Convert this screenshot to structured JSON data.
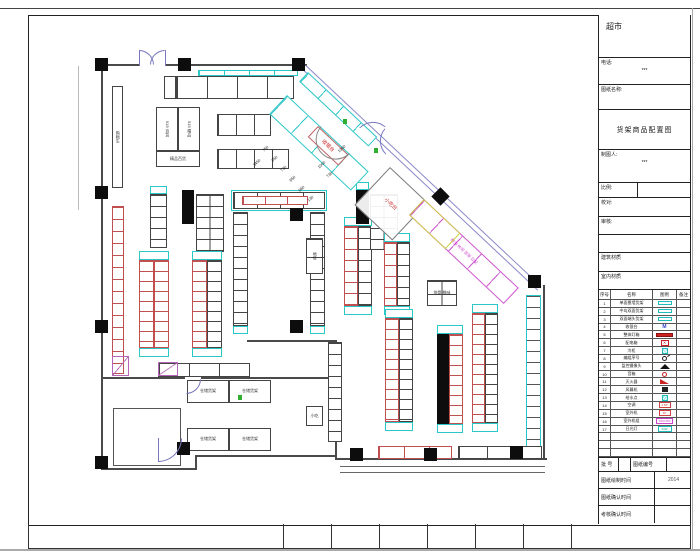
{
  "sheet": {
    "title": "超市",
    "titleblock": {
      "phone_label": "电话:",
      "phone_value": "***",
      "name_label": "图纸名称:",
      "drawing_name": "货架商品配置图",
      "drafter_label": "制图人:",
      "drafter_value": "***",
      "scale_label": "比例:",
      "check_label": "校对:",
      "review_label": "审核:",
      "building_label": "建筑材质",
      "interior_label": "室内材质",
      "batch_label": "批 号",
      "sheet_no_label": "图纸编号",
      "draw_time_label": "图纸绘制时间",
      "draw_time_value": "2014",
      "confirm_time_label": "图纸确认时间",
      "confirm_time_value": "",
      "review_time_label": "考核确认时间",
      "review_time_value": ""
    }
  },
  "legend": {
    "headers": [
      "序号",
      "名称",
      "图例",
      "备注"
    ],
    "rows": [
      {
        "no": "1",
        "name": "单面靠墙货架",
        "sym": "cyanrect",
        "glyph": ""
      },
      {
        "no": "2",
        "name": "中岛双面货架",
        "sym": "cyanrect",
        "glyph": ""
      },
      {
        "no": "3",
        "name": "双面端头货架",
        "sym": "cyanrect",
        "glyph": ""
      },
      {
        "no": "4",
        "name": "收银台",
        "sym": "mtext",
        "glyph": "M"
      },
      {
        "no": "5",
        "name": "整体灯箱",
        "sym": "redbar",
        "glyph": ""
      },
      {
        "no": "6",
        "name": "配电箱",
        "sym": "redx",
        "glyph": "✕"
      },
      {
        "no": "7",
        "name": "冷柜",
        "sym": "cyansq",
        "glyph": ""
      },
      {
        "no": "8",
        "name": "编组序号",
        "sym": "circle",
        "glyph": ""
      },
      {
        "no": "9",
        "name": "监控摄像头",
        "sym": "trap",
        "glyph": ""
      },
      {
        "no": "10",
        "name": "音箱",
        "sym": "ring",
        "glyph": ""
      },
      {
        "no": "11",
        "name": "灭火器",
        "sym": "wedge",
        "glyph": ""
      },
      {
        "no": "12",
        "name": "风幕机",
        "sym": "darksq",
        "glyph": ""
      },
      {
        "no": "13",
        "name": "给水点",
        "sym": "hatch",
        "glyph": ""
      },
      {
        "no": "14",
        "name": "空调",
        "sym": "redbox",
        "glyph": "1.5P"
      },
      {
        "no": "15",
        "name": "室外机",
        "sym": "redbox",
        "glyph": "2P"
      },
      {
        "no": "16",
        "name": "室外机组",
        "sym": "magbox",
        "glyph": "700×450"
      },
      {
        "no": "17",
        "name": "日光灯",
        "sym": "cyanbox",
        "glyph": "40W"
      },
      {
        "no": "",
        "name": "",
        "sym": "",
        "glyph": ""
      },
      {
        "no": "",
        "name": "",
        "sym": "",
        "glyph": ""
      },
      {
        "no": "",
        "name": "",
        "sym": "",
        "glyph": ""
      }
    ]
  },
  "plan": {
    "walls": [
      [
        101,
        64,
        38,
        2,
        "#4a4a4a"
      ],
      [
        166,
        64,
        141,
        2,
        "#4a4a4a"
      ],
      [
        101,
        64,
        2,
        406,
        "#4a4a4a"
      ],
      [
        101,
        468,
        96,
        2,
        "#4a4a4a"
      ],
      [
        195,
        456,
        2,
        14,
        "#4a4a4a"
      ],
      [
        195,
        455,
        142,
        2,
        "#4a4a4a"
      ],
      [
        335,
        341,
        2,
        119,
        "#4a4a4a"
      ],
      [
        247,
        340,
        90,
        2,
        "#4a4a4a"
      ],
      [
        335,
        458,
        212,
        2,
        "#4a4a4a"
      ],
      [
        340,
        466,
        205,
        1,
        "#666"
      ],
      [
        340,
        472,
        205,
        1,
        "#666"
      ],
      [
        543,
        285,
        2,
        175,
        "#4a4a4a"
      ],
      [
        101,
        377,
        84,
        2,
        "#4a4a4a"
      ],
      [
        201,
        377,
        136,
        2,
        "#4a4a4a"
      ],
      [
        78,
        66,
        1,
        144,
        "#bbb"
      ],
      [
        139,
        50,
        1,
        16,
        "#7878c0"
      ],
      [
        165,
        50,
        1,
        16,
        "#7878c0"
      ],
      [
        158,
        438,
        1,
        24,
        "#7878c0"
      ]
    ],
    "diag_wall": {
      "x": 306,
      "y": 65,
      "len": 323,
      "a": 43.2,
      "c": "#8888c8"
    },
    "columns": [
      [
        95,
        58
      ],
      [
        178,
        58
      ],
      [
        292,
        58
      ],
      [
        95,
        186
      ],
      [
        95,
        320
      ],
      [
        95,
        456
      ],
      [
        177,
        442
      ],
      [
        290,
        208
      ],
      [
        290,
        320
      ],
      [
        350,
        448
      ],
      [
        424,
        448
      ],
      [
        510,
        446
      ],
      [
        528,
        275
      ]
    ],
    "diamonds": [
      [
        434,
        190
      ]
    ],
    "solids": [
      [
        182,
        190,
        12,
        34
      ],
      [
        356,
        190,
        13,
        34
      ],
      [
        437,
        334,
        12,
        90
      ]
    ],
    "runs": [
      {
        "x": 164,
        "y": 76,
        "w": 12,
        "h": 23,
        "b": "blk"
      },
      {
        "x": 176,
        "y": 76,
        "w": 118,
        "h": 23,
        "o": "h",
        "b": "blk",
        "p": 30
      },
      {
        "x": 198,
        "y": 70,
        "w": 100,
        "h": 6,
        "o": "h",
        "b": "cyan",
        "p": 25
      },
      {
        "x": 156,
        "y": 107,
        "w": 22,
        "h": 44,
        "b": "blk",
        "label": "915 百货",
        "lr": 1
      },
      {
        "x": 178,
        "y": 107,
        "w": 22,
        "h": 44,
        "b": "blk",
        "label": "915 精品",
        "lr": 1
      },
      {
        "x": 156,
        "y": 151,
        "w": 44,
        "h": 16,
        "b": "blk",
        "label": "精品百货"
      },
      {
        "x": 217,
        "y": 114,
        "w": 54,
        "h": 22,
        "o": "h",
        "b": "blk",
        "p": 18
      },
      {
        "x": 217,
        "y": 149,
        "w": 72,
        "h": 20,
        "o": "h",
        "b": "blk",
        "p": 18
      },
      {
        "x": 112,
        "y": 86,
        "w": 11,
        "h": 102,
        "b": "blk",
        "label": "购物车",
        "lr": 1
      },
      {
        "x": 112,
        "y": 206,
        "w": 12,
        "h": 168,
        "o": "v",
        "b": "red",
        "p": 12
      },
      {
        "x": 150,
        "y": 194,
        "w": 17,
        "h": 54,
        "o": "v",
        "b": "blk",
        "p": 11
      },
      {
        "x": 196,
        "y": 194,
        "w": 28,
        "h": 58,
        "o": "v",
        "b": "blk",
        "p": 11,
        "cols": 2
      },
      {
        "x": 139,
        "y": 260,
        "w": 15,
        "h": 88,
        "o": "v",
        "b": "red",
        "p": 10
      },
      {
        "x": 154,
        "y": 260,
        "w": 15,
        "h": 88,
        "o": "v",
        "b": "red",
        "p": 10
      },
      {
        "x": 192,
        "y": 260,
        "w": 15,
        "h": 88,
        "o": "v",
        "b": "red",
        "p": 10
      },
      {
        "x": 207,
        "y": 260,
        "w": 15,
        "h": 88,
        "o": "v",
        "b": "blk",
        "p": 10
      },
      {
        "x": 231,
        "y": 190,
        "w": 96,
        "h": 21,
        "b": "cyan",
        "hollow": 1
      },
      {
        "x": 233,
        "y": 192,
        "w": 92,
        "h": 17,
        "o": "h",
        "b": "blk",
        "p": 23
      },
      {
        "x": 242,
        "y": 196,
        "w": 66,
        "h": 9,
        "o": "h",
        "b": "red",
        "p": 22
      },
      {
        "x": 233,
        "y": 212,
        "w": 15,
        "h": 114,
        "o": "v",
        "b": "blk",
        "p": 11
      },
      {
        "x": 310,
        "y": 212,
        "w": 15,
        "h": 114,
        "o": "v",
        "b": "blk",
        "p": 11
      },
      {
        "x": 344,
        "y": 226,
        "w": 14,
        "h": 80,
        "o": "v",
        "b": "red",
        "p": 11
      },
      {
        "x": 358,
        "y": 226,
        "w": 14,
        "h": 80,
        "o": "v",
        "b": "blk",
        "p": 11
      },
      {
        "x": 370,
        "y": 194,
        "w": 28,
        "h": 56,
        "o": "v",
        "b": "blk",
        "p": 11,
        "cols": 2
      },
      {
        "x": 384,
        "y": 242,
        "w": 13,
        "h": 64,
        "o": "v",
        "b": "red",
        "p": 11
      },
      {
        "x": 397,
        "y": 242,
        "w": 13,
        "h": 64,
        "o": "v",
        "b": "blk",
        "p": 11
      },
      {
        "x": 427,
        "y": 280,
        "w": 30,
        "h": 26,
        "o": "v",
        "b": "blk",
        "p": 13,
        "cols": 2,
        "label": "排骨 腊味"
      },
      {
        "x": 306,
        "y": 238,
        "w": 17,
        "h": 36,
        "o": "v",
        "b": "blk",
        "p": 18,
        "label": "地堆",
        "lr": 1
      },
      {
        "x": 306,
        "y": 406,
        "w": 17,
        "h": 20,
        "b": "blk",
        "label": "小吃"
      },
      {
        "x": 385,
        "y": 318,
        "w": 14,
        "h": 104,
        "o": "v",
        "b": "red",
        "p": 10
      },
      {
        "x": 399,
        "y": 318,
        "w": 14,
        "h": 104,
        "o": "v",
        "b": "blk",
        "p": 10
      },
      {
        "x": 449,
        "y": 334,
        "w": 14,
        "h": 90,
        "o": "v",
        "b": "red",
        "p": 10
      },
      {
        "x": 472,
        "y": 313,
        "w": 13,
        "h": 110,
        "o": "v",
        "b": "red",
        "p": 10
      },
      {
        "x": 485,
        "y": 313,
        "w": 13,
        "h": 110,
        "o": "v",
        "b": "blk",
        "p": 10
      },
      {
        "x": 526,
        "y": 295,
        "w": 15,
        "h": 152,
        "o": "v",
        "bc": "#27c7c7",
        "dc": "#555",
        "p": 11
      },
      {
        "x": 328,
        "y": 342,
        "w": 14,
        "h": 100,
        "o": "v",
        "b": "blk",
        "p": 11
      },
      {
        "x": 378,
        "y": 446,
        "w": 74,
        "h": 13,
        "o": "h",
        "b": "red",
        "p": 25
      },
      {
        "x": 458,
        "y": 446,
        "w": 84,
        "h": 13,
        "o": "h",
        "b": "blk",
        "p": 28
      },
      {
        "x": 158,
        "y": 363,
        "w": 92,
        "h": 14,
        "o": "h",
        "b": "blk",
        "p": 30
      },
      {
        "x": 187,
        "y": 380,
        "w": 42,
        "h": 23,
        "b": "blk",
        "label": "仓储货架"
      },
      {
        "x": 229,
        "y": 380,
        "w": 42,
        "h": 23,
        "b": "blk",
        "label": "仓储货架"
      },
      {
        "x": 187,
        "y": 428,
        "w": 42,
        "h": 23,
        "b": "blk",
        "label": "仓储货架"
      },
      {
        "x": 229,
        "y": 428,
        "w": 42,
        "h": 23,
        "b": "blk",
        "label": "仓储货架"
      },
      {
        "x": 113,
        "y": 408,
        "w": 68,
        "h": 58,
        "bc": "#555",
        "hollow": 1
      },
      {
        "x": 139,
        "y": 251,
        "w": 30,
        "h": 9,
        "b": "cyan"
      },
      {
        "x": 139,
        "y": 348,
        "w": 30,
        "h": 9,
        "b": "cyan"
      },
      {
        "x": 192,
        "y": 251,
        "w": 30,
        "h": 9,
        "b": "cyan"
      },
      {
        "x": 192,
        "y": 348,
        "w": 30,
        "h": 9,
        "b": "cyan"
      },
      {
        "x": 344,
        "y": 217,
        "w": 28,
        "h": 9,
        "b": "cyan"
      },
      {
        "x": 344,
        "y": 306,
        "w": 28,
        "h": 9,
        "b": "cyan"
      },
      {
        "x": 384,
        "y": 233,
        "w": 26,
        "h": 9,
        "b": "cyan"
      },
      {
        "x": 384,
        "y": 306,
        "w": 26,
        "h": 9,
        "b": "cyan"
      },
      {
        "x": 385,
        "y": 309,
        "w": 28,
        "h": 9,
        "b": "cyan"
      },
      {
        "x": 385,
        "y": 422,
        "w": 28,
        "h": 9,
        "b": "cyan"
      },
      {
        "x": 437,
        "y": 325,
        "w": 26,
        "h": 9,
        "b": "cyan"
      },
      {
        "x": 437,
        "y": 424,
        "w": 26,
        "h": 9,
        "b": "cyan"
      },
      {
        "x": 472,
        "y": 304,
        "w": 26,
        "h": 9,
        "b": "cyan"
      },
      {
        "x": 472,
        "y": 423,
        "w": 26,
        "h": 9,
        "b": "cyan"
      },
      {
        "x": 233,
        "y": 326,
        "w": 15,
        "h": 8,
        "b": "cyan"
      },
      {
        "x": 310,
        "y": 326,
        "w": 15,
        "h": 8,
        "b": "cyan"
      },
      {
        "x": 150,
        "y": 186,
        "w": 17,
        "h": 8,
        "b": "cyan"
      },
      {
        "x": 356,
        "y": 182,
        "w": 13,
        "h": 8,
        "b": "cyan"
      }
    ],
    "diags": [
      {
        "x": 308,
        "y": 72,
        "len": 95,
        "h": 13,
        "a": 43.2,
        "bc": "#2cc7c7",
        "p": 24
      },
      {
        "x": 287,
        "y": 95,
        "len": 112,
        "h": 26,
        "a": 43.2,
        "bc": "#2cc7c7",
        "p": 28
      },
      {
        "x": 318,
        "y": 126,
        "len": 42,
        "h": 15,
        "a": 43.2,
        "bc": "#c06060",
        "label": "收银台",
        "lc": "#cc2222",
        "fs": 5
      },
      {
        "x": 390,
        "y": 167,
        "len": 52,
        "h": 52,
        "a": 43.2,
        "bc": "#777",
        "label": "小吃台",
        "lc": "#cc3333",
        "fs": 5
      },
      {
        "x": 424,
        "y": 199,
        "len": 130,
        "h": 22,
        "a": 43.2,
        "bc": "#cc55cc",
        "p": 26,
        "label": "粮油  休闲  百货  日配",
        "lc": "#cc44cc",
        "fs": 4
      },
      {
        "x": 424,
        "y": 199,
        "len": 50,
        "h": 22,
        "a": 43.2,
        "bc": "#cccc44",
        "hollow": 1
      }
    ],
    "arcs": [
      {
        "x": 139,
        "y": 50,
        "s": 15,
        "corner": "tr",
        "rot": 0,
        "c": "#7878c0"
      },
      {
        "x": 150,
        "y": 50,
        "s": 15,
        "corner": "tl",
        "rot": 0,
        "c": "#7878c0"
      },
      {
        "x": 372,
        "y": 114,
        "s": 19,
        "corner": "tl",
        "rot": 43,
        "c": "#7878c0"
      },
      {
        "x": 385,
        "y": 128,
        "s": 19,
        "corner": "bl",
        "rot": 43,
        "c": "#7878c0"
      },
      {
        "x": 186,
        "y": 379,
        "s": 15,
        "corner": "br",
        "rot": 0,
        "c": "#7878c0"
      },
      {
        "x": 158,
        "y": 438,
        "s": 24,
        "corner": "br",
        "rot": 0,
        "c": "#7878c0"
      },
      {
        "x": 321,
        "y": 126,
        "s": 40,
        "half": 1,
        "rot": 43,
        "c": "#888"
      }
    ],
    "dims": [
      {
        "x": 262,
        "y": 146,
        "t": "750"
      },
      {
        "x": 271,
        "y": 156,
        "t": "650"
      },
      {
        "x": 280,
        "y": 166,
        "t": "730"
      },
      {
        "x": 289,
        "y": 176,
        "t": "650"
      },
      {
        "x": 298,
        "y": 186,
        "t": "660"
      },
      {
        "x": 307,
        "y": 196,
        "t": "130"
      },
      {
        "x": 252,
        "y": 160,
        "t": "3450"
      },
      {
        "x": 317,
        "y": 162,
        "t": "1000"
      },
      {
        "x": 326,
        "y": 172,
        "t": "730"
      },
      {
        "x": 337,
        "y": 146,
        "t": "1360"
      }
    ],
    "greens": [
      [
        343,
        119
      ],
      [
        374,
        148
      ],
      [
        238,
        395
      ]
    ],
    "tris": [
      [
        112,
        356,
        17,
        20
      ],
      [
        158,
        362,
        20,
        14
      ]
    ],
    "strip_dividers": [
      254,
      302,
      350,
      398,
      446,
      494,
      542
    ]
  }
}
